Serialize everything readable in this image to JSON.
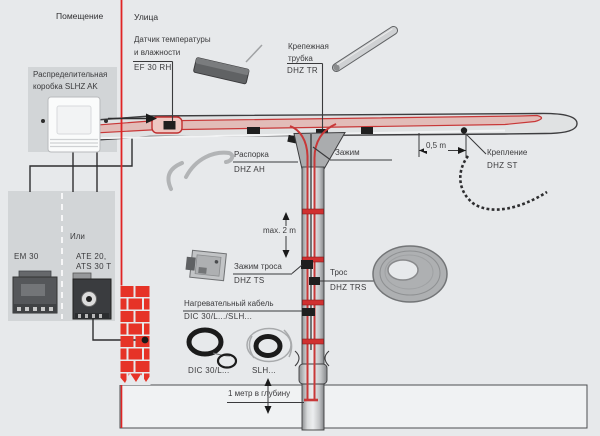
{
  "zones": {
    "indoor": "Помещение",
    "outdoor": "Улица"
  },
  "junction_box": {
    "label_line1": "Распределительная",
    "label_line2": "коробка SLHZ AK"
  },
  "sensor": {
    "label_line1": "Датчик температуры",
    "label_line2": "и влажности",
    "code": "EF 30 RH"
  },
  "tube": {
    "label_line1": "Крепежная",
    "label_line2": "трубка",
    "code": "DHZ TR"
  },
  "spacer": {
    "label": "Распорка",
    "code": "DHZ AH"
  },
  "clamp": {
    "label": "Зажим"
  },
  "fastener": {
    "label": "Крепление",
    "code": "DHZ ST"
  },
  "rope_clamp": {
    "label": "Зажим троса",
    "code": "DHZ TS"
  },
  "rope": {
    "label": "Трос",
    "code": "DHZ TRS"
  },
  "heating_cable": {
    "label": "Нагревательный кабель",
    "code": "DIC 30/L.../SLH..."
  },
  "coils": {
    "dic": "DIC 30/L...",
    "slh": "SLH..."
  },
  "devices": {
    "em": "EM 30",
    "or": "Или",
    "ate_line1": "ATE 20,",
    "ate_line2": "ATS 30 T"
  },
  "dimensions": {
    "gutter_spacing": "0,5 m",
    "downpipe_spacing": "max. 2 m",
    "depth": "1 метр в глубину"
  },
  "colors": {
    "heating_cable_red": "#c83838",
    "wall_red": "#e02424",
    "brick_red": "#e63327",
    "background": "#e7e9eb"
  }
}
